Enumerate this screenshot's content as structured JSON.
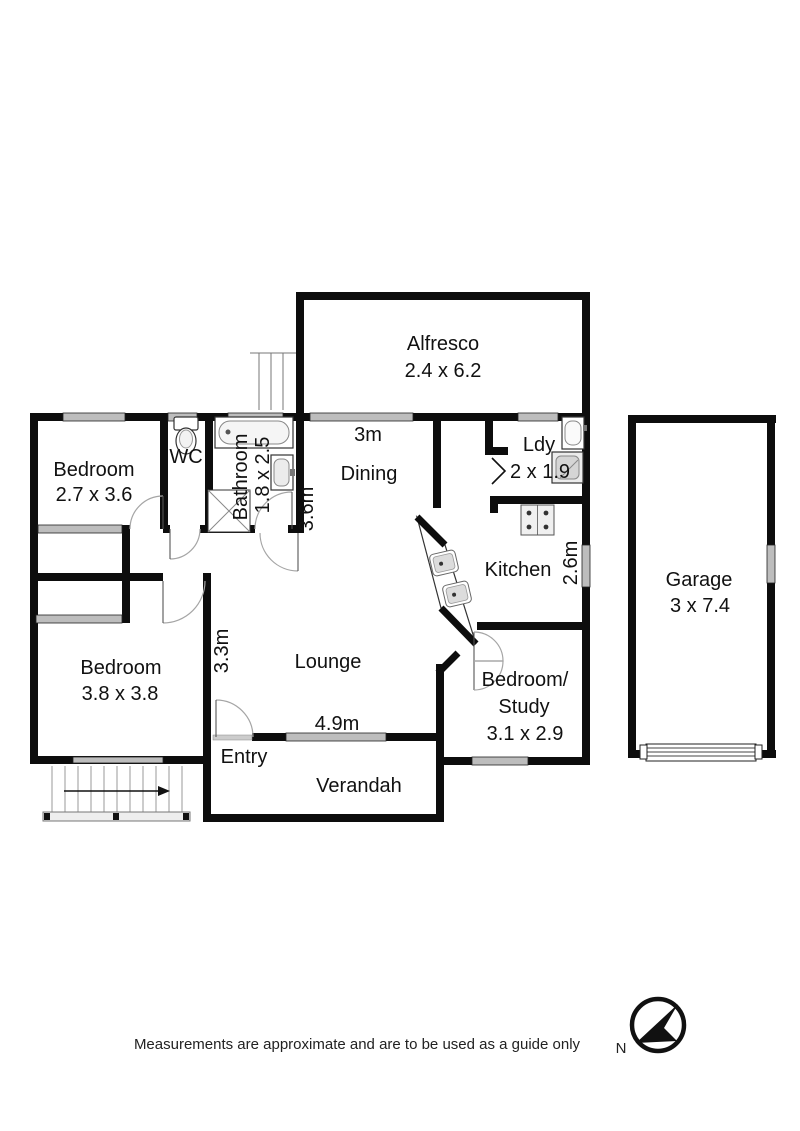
{
  "plan": {
    "rooms": {
      "alfresco": {
        "name": "Alfresco",
        "dims": "2.4 x 6.2"
      },
      "bedroom1": {
        "name": "Bedroom",
        "dims": "2.7 x 3.6"
      },
      "wc": {
        "name": "WC"
      },
      "bathroom": {
        "name": "Bathroom",
        "dims": "1.8 x 2.5"
      },
      "dining": {
        "name": "Dining",
        "width_label": "3m",
        "depth_label": "3.6m"
      },
      "laundry": {
        "name": "Ldy",
        "dims": "2 x 1.9"
      },
      "kitchen": {
        "name": "Kitchen",
        "depth_label": "2.6m"
      },
      "garage": {
        "name": "Garage",
        "dims": "3 x 7.4"
      },
      "bedroom2": {
        "name": "Bedroom",
        "dims": "3.8 x 3.8"
      },
      "lounge": {
        "name": "Lounge",
        "depth_label": "3.3m",
        "width_label": "4.9m"
      },
      "entry": {
        "name": "Entry"
      },
      "verandah": {
        "name": "Verandah"
      },
      "bedroom_study": {
        "name_line1": "Bedroom/",
        "name_line2": "Study",
        "dims": "3.1 x 2.9"
      }
    },
    "compass": {
      "label": "N"
    },
    "footer": {
      "disclaimer": "Measurements are approximate and are to be used as a guide only"
    },
    "colors": {
      "wall": "#0d0d0d",
      "window": "#bdbdbd",
      "background": "#ffffff"
    }
  }
}
